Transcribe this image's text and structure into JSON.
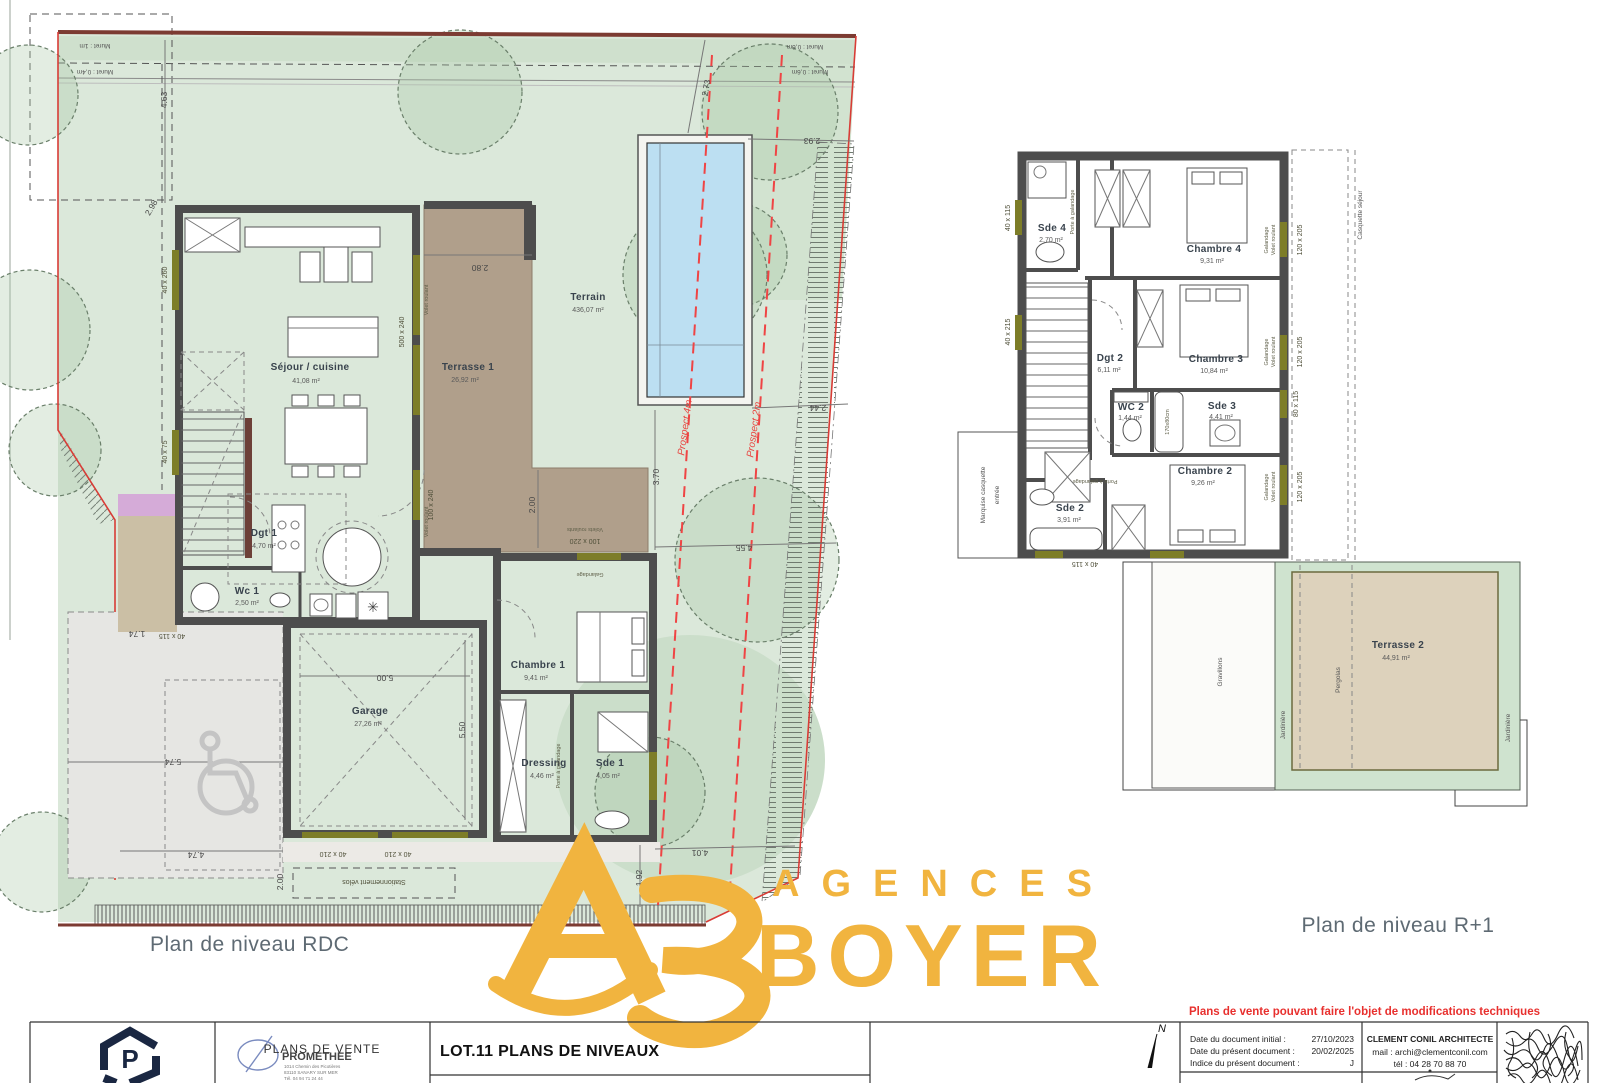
{
  "captions": {
    "rdc": "Plan de niveau RDC",
    "r1": "Plan de niveau R+1"
  },
  "disclaimer": "Plans de vente pouvant faire l'objet de modifications techniques",
  "brand": {
    "word1": "AGENCES",
    "word2": "BOYER",
    "color": "#f1b43f"
  },
  "rdc": {
    "rooms": {
      "terrain": {
        "n": "Terrain",
        "a": "436,07 m²"
      },
      "sejour": {
        "n": "Séjour / cuisine",
        "a": "41,08 m²"
      },
      "terrasse1": {
        "n": "Terrasse 1",
        "a": "26,92 m²"
      },
      "dgt1": {
        "n": "Dgt 1",
        "a": "4,70 m²"
      },
      "wc1": {
        "n": "Wc 1",
        "a": "2,50 m²"
      },
      "chambre1": {
        "n": "Chambre 1",
        "a": "9,41 m²"
      },
      "dressing": {
        "n": "Dressing",
        "a": "4,46 m²"
      },
      "sde1": {
        "n": "Sde 1",
        "a": "4,05 m²"
      },
      "garage": {
        "n": "Garage",
        "a": "27,26 m²"
      }
    },
    "labels": {
      "velos": "Stationnement vélos",
      "prospect4": "Prospect 4m",
      "prospect2": "Prospect 2m",
      "muret1": "Muret : 1m",
      "muret04": "Muret : 0,4m",
      "muret06": "Muret : 0,6m",
      "volet": "Volet roulant",
      "volets": "Volets roulants",
      "galandage": "Galandage",
      "porteg": "Porte à galandage"
    },
    "tags": {
      "w260": "40 x 260",
      "w75": "40 x 75",
      "w500": "500 x 240",
      "w100": "100 x 240",
      "w115": "40 x 115",
      "w210a": "40 x 210",
      "w210b": "40 x 210",
      "w220": "100 x 220"
    },
    "dims": {
      "d463": "4.63",
      "d298": "2.98",
      "d273": "2.73",
      "d293": "2.93",
      "d280": "2.80",
      "d244": "2.44",
      "d370": "3.70",
      "d200": "2.00",
      "d455": "4.55",
      "d401": "4.01",
      "d192": "1.92",
      "d174": "1.74",
      "d574": "5.74",
      "d474": "4.74",
      "d200b": "2.00",
      "d500": "5.00",
      "d550": "5.50"
    }
  },
  "r1": {
    "rooms": {
      "sde4": {
        "n": "Sde 4",
        "a": "2,70 m²"
      },
      "chambre4": {
        "n": "Chambre 4",
        "a": "9,31 m²"
      },
      "dgt2": {
        "n": "Dgt 2",
        "a": "6,11 m²"
      },
      "chambre3": {
        "n": "Chambre 3",
        "a": "10,84 m²"
      },
      "wc2": {
        "n": "WC 2",
        "a": "1,44 m²"
      },
      "sde3": {
        "n": "Sde 3",
        "a": "4,41 m²"
      },
      "chambre2": {
        "n": "Chambre 2",
        "a": "9,26 m²"
      },
      "sde2": {
        "n": "Sde 2",
        "a": "3,91 m²"
      },
      "terrasse2": {
        "n": "Terrasse 2",
        "a": "44,91 m²"
      }
    },
    "labels": {
      "marquise1": "Marquise casquette",
      "marquise2": "entrée",
      "casquette": "Casquette séjour",
      "gravillons": "Gravillons",
      "jardiniere": "Jardinière",
      "pergolas": "Pergolas",
      "galandage": "Galandage",
      "volet": "Volet roulant",
      "porteg": "Porte à galandage",
      "tub": "170x80cm"
    },
    "tags": {
      "w115a": "40 x 115",
      "w215": "40 x 215",
      "w120a": "120 x 205",
      "w120b": "120 x 205",
      "w80": "80 x 115",
      "w120c": "120 x 205",
      "w115b": "40 x 115"
    }
  },
  "title_block": {
    "promethee": {
      "name": "PROMETHEE",
      "addr1": "1014 Chemin des Picotières",
      "addr2": "83110 SANARY SUR MER",
      "addr3": "Tél. 04 94 71 24 44"
    },
    "doc_type": "PLANS DE VENTE",
    "doc_title": "LOT.11 PLANS DE NIVEAUX",
    "north": "N",
    "rows": [
      {
        "label": "Date du document initial :",
        "value": "27/10/2023"
      },
      {
        "label": "Date du présent document :",
        "value": "20/02/2025"
      },
      {
        "label": "Indice du présent document :",
        "value": "J"
      }
    ],
    "architect": {
      "name": "CLEMENT CONIL ARCHITECTE",
      "mail": "mail : archi@clementconil.com",
      "tel": "tél : 04 28 70 88 70"
    }
  }
}
